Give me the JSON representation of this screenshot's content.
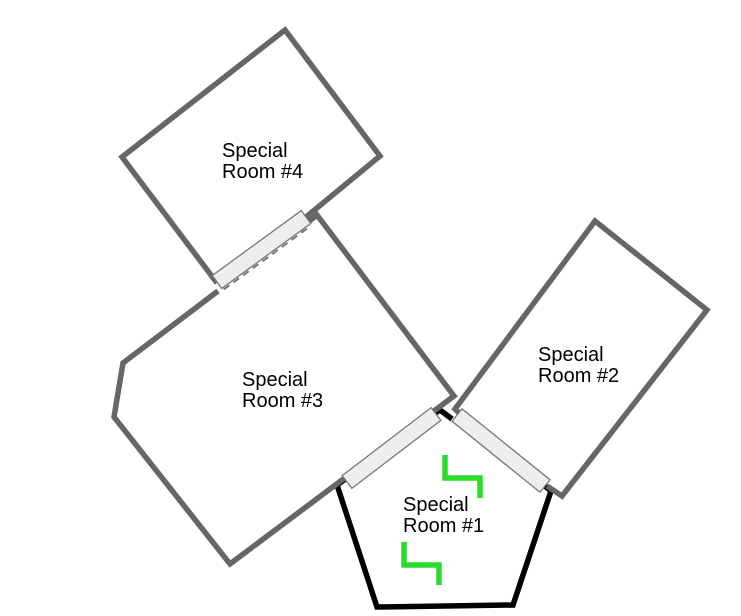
{
  "diagram": {
    "type": "floor-plan",
    "canvas": {
      "width": 741,
      "height": 616,
      "background": "#ffffff"
    },
    "palette": {
      "wall": "#666666",
      "room1_wall": "#000000",
      "door_fill": "#eeeeee",
      "door_stroke": "#777777",
      "marker_green": "#2bdd2b",
      "label_text": "#000000"
    },
    "wall_stroke_width": 5.5,
    "marker_stroke_width": 5.5,
    "rooms": [
      {
        "id": "special-room-1",
        "name": "Special Room #1",
        "label_lines": [
          "Special",
          "Room #1"
        ],
        "label_x": 403,
        "label_y": 511,
        "line_height": 21,
        "wall_color_key": "room1_wall",
        "wall_paths": [
          [
            [
              540,
              482
            ],
            [
              551,
              491
            ],
            [
              513,
              605
            ],
            [
              377,
              607
            ],
            [
              337,
              485
            ],
            [
              348,
              477
            ]
          ],
          [
            [
              431,
              416
            ],
            [
              440,
              410
            ],
            [
              452,
              419
            ]
          ]
        ]
      },
      {
        "id": "special-room-2",
        "name": "Special Room #2",
        "label_lines": [
          "Special",
          "Room #2"
        ],
        "label_x": 538,
        "label_y": 361,
        "line_height": 21,
        "wall_color_key": "wall",
        "wall_paths": [
          [
            [
              462,
              416
            ],
            [
              455,
              409
            ],
            [
              595,
              221
            ],
            [
              707,
              310
            ],
            [
              562,
              496
            ],
            [
              547,
              486
            ]
          ]
        ]
      },
      {
        "id": "special-room-3",
        "name": "Special Room #3",
        "label_lines": [
          "Special",
          "Room #3"
        ],
        "label_x": 242,
        "label_y": 386,
        "line_height": 21,
        "wall_color_key": "wall",
        "wall_paths": [
          [
            [
              297,
              231
            ],
            [
              317,
              215
            ],
            [
              454,
              396
            ],
            [
              230,
              564
            ],
            [
              114,
              417
            ],
            [
              123,
              363
            ],
            [
              218,
              291
            ]
          ]
        ]
      },
      {
        "id": "special-room-4",
        "name": "Special Room #4",
        "label_lines": [
          "Special",
          "Room #4"
        ],
        "label_x": 222,
        "label_y": 157,
        "line_height": 21,
        "wall_color_key": "wall",
        "wall_paths": [
          [
            [
              306,
              217
            ],
            [
              380,
              156
            ],
            [
              285,
              30
            ],
            [
              122,
              157
            ],
            [
              217,
              283
            ]
          ]
        ]
      }
    ],
    "doors": [
      {
        "id": "door-room3-room4",
        "from": [
          217,
          282
        ],
        "to": [
          306,
          217
        ],
        "thickness": 16,
        "dashed": true
      },
      {
        "id": "door-room1-room3",
        "from": [
          347,
          482
        ],
        "to": [
          436,
          414
        ],
        "thickness": 16,
        "dashed": false
      },
      {
        "id": "door-room1-room2",
        "from": [
          457,
          415
        ],
        "to": [
          545,
          486
        ],
        "thickness": 16,
        "dashed": false
      }
    ],
    "markers": [
      {
        "id": "step-marker-1",
        "points": [
          [
            445,
            455
          ],
          [
            445,
            478
          ],
          [
            480,
            478
          ],
          [
            480,
            498
          ]
        ]
      },
      {
        "id": "step-marker-2",
        "points": [
          [
            404,
            542
          ],
          [
            404,
            565
          ],
          [
            439,
            565
          ],
          [
            439,
            585
          ]
        ]
      }
    ]
  }
}
